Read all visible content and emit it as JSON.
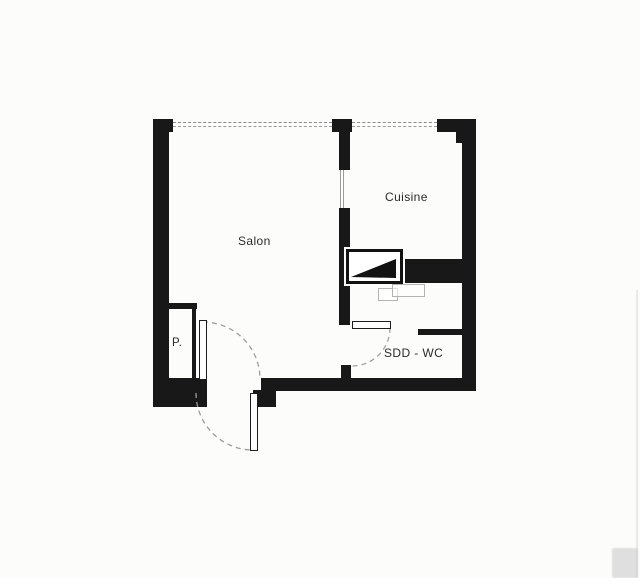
{
  "document": {
    "type": "apartment-floor-plan",
    "style": "scanned black-and-white architectural drawing"
  },
  "rooms": [
    {
      "id": "salon",
      "label": "Salon"
    },
    {
      "id": "cuisine",
      "label": "Cuisine"
    },
    {
      "id": "placard",
      "label": "P."
    },
    {
      "id": "sdd_wc",
      "label": "SDD - WC"
    }
  ],
  "symbols": {
    "windows": [
      "top-window-salon",
      "top-window-cuisine",
      "interior-glazed-panel"
    ],
    "doors": [
      "entry-double-leaf-door",
      "sdd-wc-door"
    ],
    "fixtures": [
      "technical-duct",
      "washbasin-outline"
    ]
  },
  "colors": {
    "wall": "#181818",
    "background": "#fcfcfb",
    "window_line": "#8a8a8a",
    "door_arc": "#9b9b9b",
    "label_text": "#2b2b2b",
    "fixture_outline": "#b4b4b4",
    "scan_artifact": "#c9c9c9"
  }
}
